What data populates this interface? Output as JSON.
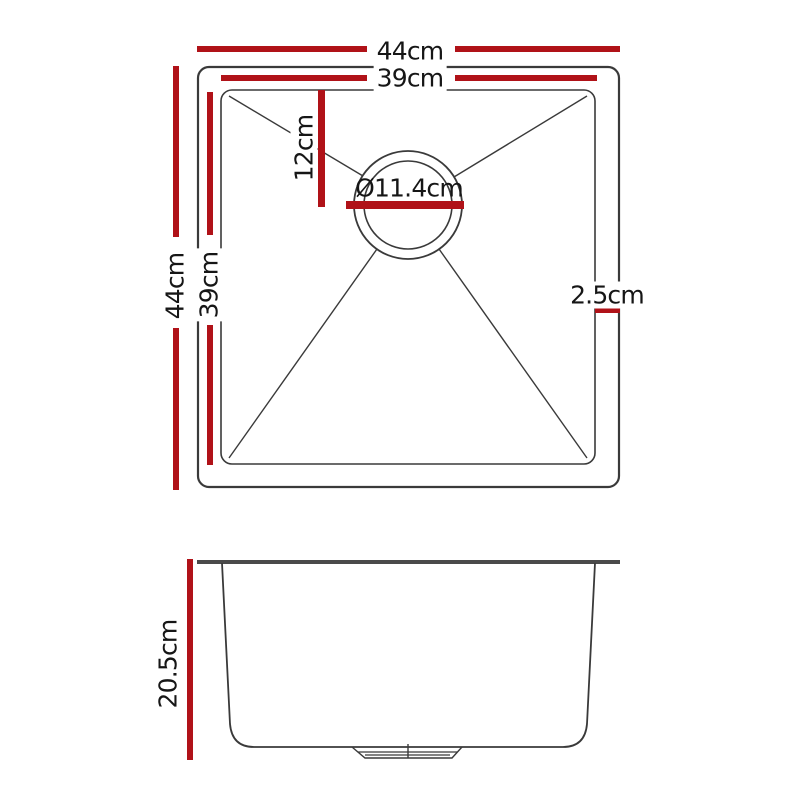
{
  "colors": {
    "dimension_red": "#b01218",
    "line_dark": "#3a3a3a",
    "rim_line": "#4a4a4a",
    "text_dark": "#161616"
  },
  "top_view": {
    "outer_width_label": "44cm",
    "inner_width_label": "39cm",
    "outer_height_label": "44cm",
    "inner_height_label": "39cm",
    "drain_offset_label": "12cm",
    "drain_diameter_label": "Ø11.4cm",
    "rim_width_label": "2.5cm"
  },
  "side_view": {
    "depth_label": "20.5cm"
  }
}
